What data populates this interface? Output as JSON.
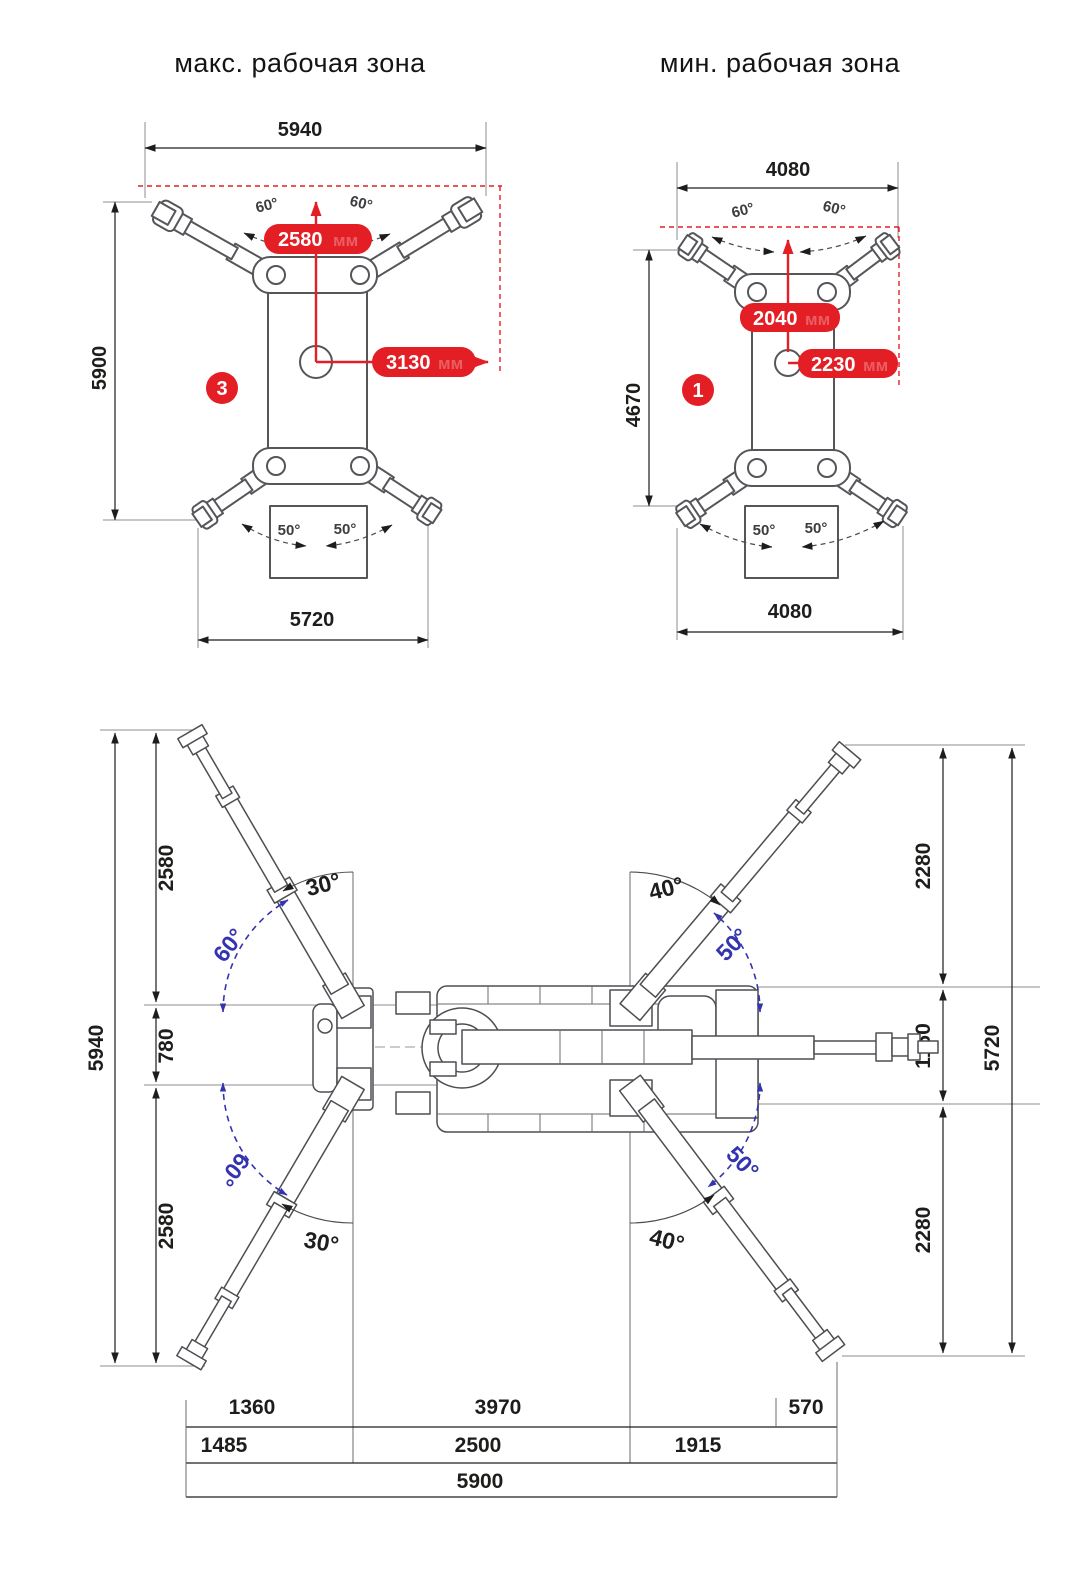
{
  "titles": {
    "max": "макс. рабочая зона",
    "min": "мин. рабочая зона"
  },
  "unit_ghost": "мм",
  "max_zone": {
    "badge": "3",
    "dim_top": "5940",
    "dim_left": "5900",
    "dim_bottom": "5720",
    "reach_forward": "2580",
    "reach_side": "3130",
    "angle_top_left": "60°",
    "angle_top_right": "60°",
    "angle_bottom_left": "50°",
    "angle_bottom_right": "50°"
  },
  "min_zone": {
    "badge": "1",
    "dim_top": "4080",
    "dim_left": "4670",
    "dim_bottom": "4080",
    "reach_forward": "2040",
    "reach_side": "2230",
    "angle_top_left": "60°",
    "angle_top_right": "60°",
    "angle_bottom_left": "50°",
    "angle_bottom_right": "50°"
  },
  "plan": {
    "dim_left_total": "5940",
    "dim_left_top": "2580",
    "dim_left_mid": "780",
    "dim_left_bottom": "2580",
    "dim_right_top": "2280",
    "dim_right_mid": "1160",
    "dim_right_bottom": "2280",
    "dim_right_total": "5720",
    "angle_tl_outer": "30°",
    "angle_tl_inner": "60°",
    "angle_tr_outer": "40°",
    "angle_tr_inner": "50°",
    "angle_bl_outer": "30°",
    "angle_bl_inner": "60°",
    "angle_br_outer": "40°",
    "angle_br_inner": "50°",
    "row1": {
      "c1": "1360",
      "c2": "3970",
      "c3": "570"
    },
    "row2": {
      "c1": "1485",
      "c2": "2500",
      "c3": "1915"
    },
    "row3": {
      "total": "5900"
    }
  },
  "colors": {
    "red": "#e31e24",
    "blue": "#3434b0",
    "line": "#55565a"
  }
}
